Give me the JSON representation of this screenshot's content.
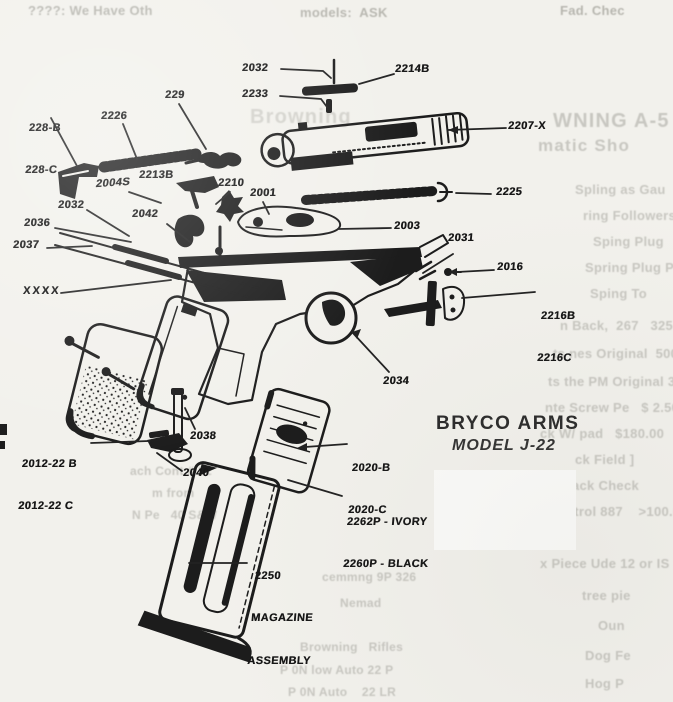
{
  "document": {
    "brand": "BRYCO ARMS",
    "model": "MODEL J-22"
  },
  "parts": {
    "p2032": "2032",
    "p2214b": "2214B",
    "p2233": "2233",
    "p229": "229",
    "p228b": "228-B",
    "p228c": "228-C",
    "p2226": "2226",
    "p2207x": "2207-X",
    "p2004s": "2004S",
    "p2213b": "2213B",
    "p2210": "2210",
    "p2001": "2001",
    "p2225": "2225",
    "p2003": "2003",
    "p2031": "2031",
    "p2016": "2016",
    "p2216b": "2216B",
    "p2216c": "2216C",
    "p2036": "2036",
    "p2037": "2037",
    "pxxxx": "XXXX",
    "p2042": "2042",
    "p2034": "2034",
    "p2012b": "2012-22 B",
    "p2012c": "2012-22 C",
    "p2038": "2038",
    "p2040": "2040",
    "p2020b": "2020-B",
    "p2020c": "2020-C",
    "p2262": "2262P - IVORY",
    "p2260": "2260P - BLACK",
    "p2250_num": "2250",
    "p2250_line1": "MAGAZINE",
    "p2250_line2": "ASSEMBLY"
  },
  "bleedthrough": {
    "t1": "????: We Have Oth",
    "t2": "models:  ASK",
    "t3": "Fad. Chec",
    "g1": "Browning",
    "r1": "WNING A-5",
    "r2": "matic Sho",
    "r3": "Spling as Gau",
    "r4": "ring Followers    $15.",
    "r5": "Sping Plug        5.50",
    "r6": "Spring Plug Pe  2.50",
    "r7": "Sping To         5.50",
    "r8": "n Back,  267   325.00",
    "r9": "ts nes Original  500.00",
    "r10": "ts the PM Original 325.00",
    "r11": "nte Screw Pe   $ 2.50",
    "r12": "ck W/ pad   $180.00",
    "r13": "ck Field ]",
    "r14": "ack Check",
    "r15": "ntrol 887    >100.00",
    "r16": "x Piece Ude 12 or IS 500.00",
    "r17": "tree pie",
    "r18": "Oun",
    "r19": "Dog Fe",
    "r20": "Hog P",
    "m1": "ach Cont # 22",
    "m2": "m from",
    "m3": "N Pe   40 S&W",
    "b1": "cemmng 9P 326",
    "b2": "Nemad",
    "b3": "Browning   Rifles",
    "b4": "P 0N low Auto 22 P",
    "b5": "P 0N Auto    22 LR"
  }
}
